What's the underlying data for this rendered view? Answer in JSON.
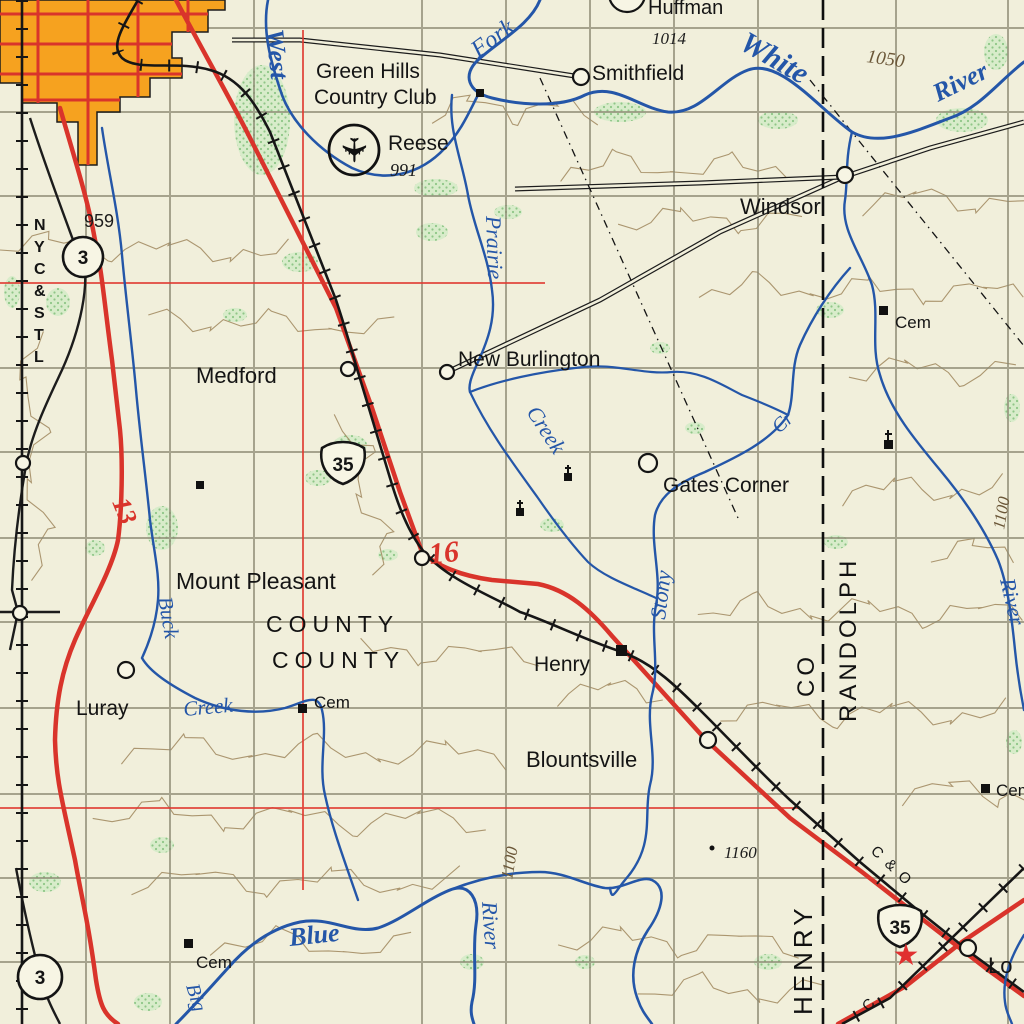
{
  "colors": {
    "background": "#f1efdb",
    "water_blue": "#2456a8",
    "primary_road_red": "#d9342b",
    "urban_orange": "#f6a21f",
    "woodland_green": "#d8ecca",
    "contour_brown": "#9a8055",
    "railroad_black": "#161616"
  },
  "icons": {
    "airport": "✈",
    "star": "★"
  },
  "settlements": {
    "huffman": "Huffman",
    "smithfield": "Smithfield",
    "windsor": "Windsor",
    "medford": "Medford",
    "new_burlington": "New Burlington",
    "gates_corner": "Gates Corner",
    "mount_pleasant": "Mount Pleasant",
    "luray": "Luray",
    "henry": "Henry",
    "blountsville": "Blountsville",
    "losantville_partial": "Lo"
  },
  "hydrography": {
    "west": "West",
    "fork": "Fork",
    "white": "White",
    "river_ne": "River",
    "prairie": "Prairie",
    "creek_prairie": "Creek",
    "stony": "Stony",
    "cr": "Cr",
    "buck": "Buck",
    "creek_buck": "Creek",
    "blue": "Blue",
    "big": "Big",
    "river_south": "River",
    "river_east": "River"
  },
  "counties": {
    "henry": "HENRY",
    "henry_co": "CO",
    "randolph": "RANDOLPH",
    "county_label_1": "COUNTY",
    "county_label_2": "COUNTY"
  },
  "routes": {
    "us35_north": "35",
    "us35_south": "35",
    "state3_north": "3",
    "state3_south": "3",
    "red_13": "13",
    "red_16": "16"
  },
  "railroads": {
    "nyc_stl": "NYC&STL",
    "c_and_o": "C & O",
    "c_fragment": "C"
  },
  "elevations": {
    "pt_959": "959",
    "pt_991": "991",
    "pt_1014": "1014",
    "pt_1160": "1160",
    "contour_1050": "1050",
    "contour_1100_a": "1100",
    "contour_1100_b": "1100"
  },
  "features": {
    "golf_club_line1": "Green Hills",
    "golf_club_line2": "Country Club",
    "airfield_name": "Reese",
    "cemetery_ne": "Cem",
    "cemetery_center": "Cem",
    "cemetery_sw": "Cem",
    "cemetery_east": "Cem"
  }
}
